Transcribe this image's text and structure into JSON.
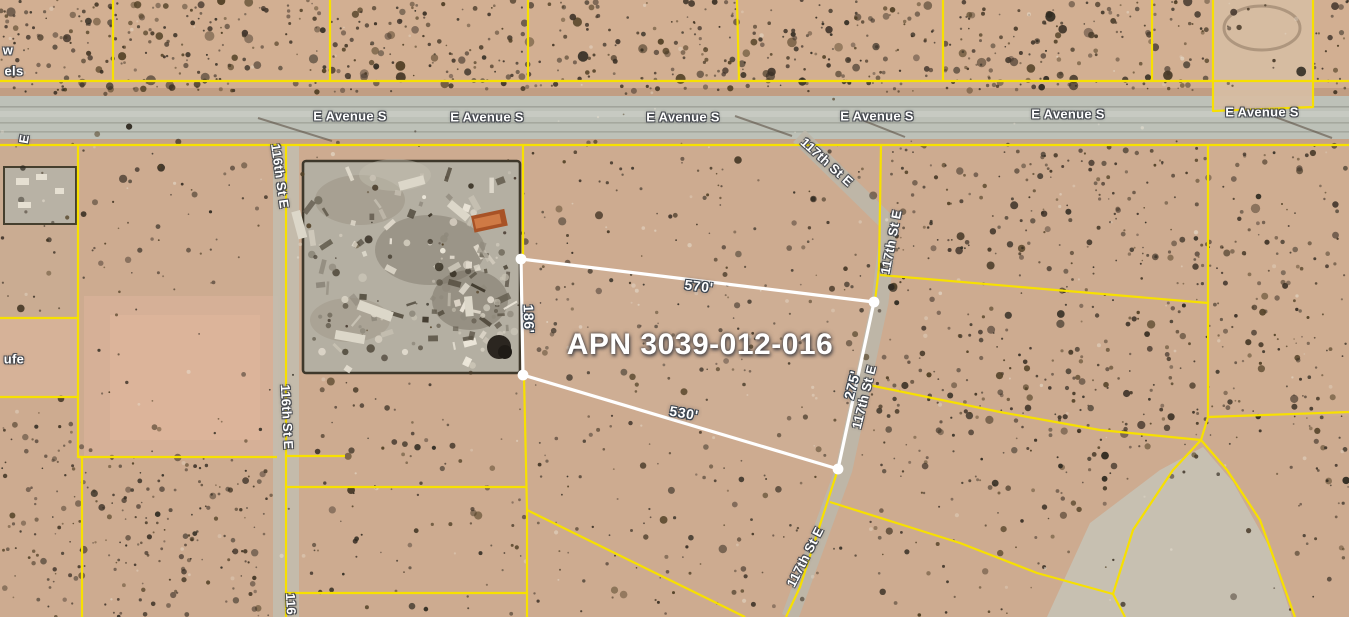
{
  "map": {
    "apn_label": {
      "text": "APN 3039-012-016",
      "x": 700,
      "y": 345
    },
    "parcel": {
      "corners": [
        [
          521,
          259
        ],
        [
          874,
          302
        ],
        [
          838,
          469
        ],
        [
          523,
          375
        ]
      ],
      "dimension_labels": [
        {
          "text": "570'",
          "x": 699,
          "y": 286,
          "r": 7
        },
        {
          "text": "186'",
          "x": 529,
          "y": 319,
          "r": 88
        },
        {
          "text": "275'",
          "x": 852,
          "y": 385,
          "r": -76
        },
        {
          "text": "530'",
          "x": 684,
          "y": 413,
          "r": 10
        }
      ]
    },
    "street_labels": [
      {
        "text": "E Avenue S",
        "x": 350,
        "y": 116,
        "r": 0
      },
      {
        "text": "E Avenue S",
        "x": 487,
        "y": 117,
        "r": 0
      },
      {
        "text": "E Avenue S",
        "x": 683,
        "y": 117,
        "r": 0
      },
      {
        "text": "E Avenue S",
        "x": 877,
        "y": 116,
        "r": 0
      },
      {
        "text": "E Avenue S",
        "x": 1068,
        "y": 114,
        "r": 0
      },
      {
        "text": "E Avenue S",
        "x": 1262,
        "y": 112,
        "r": 0
      },
      {
        "text": "116th St E",
        "x": 280,
        "y": 176,
        "r": 82
      },
      {
        "text": "116th St E",
        "x": 287,
        "y": 417,
        "r": 87
      },
      {
        "text": "116",
        "x": 291,
        "y": 604,
        "r": 87
      },
      {
        "text": "117th St E",
        "x": 827,
        "y": 162,
        "r": 42
      },
      {
        "text": "117th St E",
        "x": 891,
        "y": 242,
        "r": -79
      },
      {
        "text": "117th St E",
        "x": 864,
        "y": 397,
        "r": -76
      },
      {
        "text": "117th St E",
        "x": 805,
        "y": 557,
        "r": -63
      },
      {
        "text": "E",
        "x": 24,
        "y": 139,
        "r": -80
      }
    ],
    "edge_partial_labels": [
      {
        "text": "w",
        "x": 8,
        "y": 50
      },
      {
        "text": "els",
        "x": 14,
        "y": 71
      },
      {
        "text": "ufe",
        "x": 14,
        "y": 359
      }
    ],
    "parcel_lines": [
      [
        [
          0,
          81
        ],
        [
          1349,
          81
        ]
      ],
      [
        [
          113,
          0
        ],
        [
          113,
          81
        ]
      ],
      [
        [
          330,
          0
        ],
        [
          330,
          81
        ]
      ],
      [
        [
          528,
          0
        ],
        [
          528,
          81
        ]
      ],
      [
        [
          737,
          0
        ],
        [
          739,
          81
        ]
      ],
      [
        [
          943,
          0
        ],
        [
          943,
          81
        ]
      ],
      [
        [
          1152,
          0
        ],
        [
          1152,
          81
        ]
      ],
      [
        [
          1213,
          0
        ],
        [
          1213,
          111
        ],
        [
          1313,
          107
        ],
        [
          1313,
          0
        ]
      ],
      [
        [
          0,
          145
        ],
        [
          1349,
          145
        ]
      ],
      [
        [
          78,
          145
        ],
        [
          78,
          457
        ],
        [
          82,
          457
        ],
        [
          82,
          617
        ]
      ],
      [
        [
          0,
          318
        ],
        [
          78,
          318
        ]
      ],
      [
        [
          0,
          397
        ],
        [
          78,
          397
        ]
      ],
      [
        [
          78,
          457
        ],
        [
          277,
          457
        ]
      ],
      [
        [
          286,
          145
        ],
        [
          286,
          617
        ]
      ],
      [
        [
          286,
          456
        ],
        [
          345,
          456
        ]
      ],
      [
        [
          286,
          487
        ],
        [
          527,
          487
        ]
      ],
      [
        [
          286,
          593
        ],
        [
          527,
          593
        ]
      ],
      [
        [
          523,
          145
        ],
        [
          523,
          257
        ]
      ],
      [
        [
          524,
          377
        ],
        [
          527,
          510
        ],
        [
          527,
          617
        ]
      ],
      [
        [
          527,
          510
        ],
        [
          745,
          617
        ]
      ],
      [
        [
          881,
          145
        ],
        [
          879,
          268
        ],
        [
          875,
          301
        ]
      ],
      [
        [
          880,
          275
        ],
        [
          1208,
          303
        ]
      ],
      [
        [
          1208,
          145
        ],
        [
          1208,
          417
        ],
        [
          1201,
          440
        ]
      ],
      [
        [
          1208,
          417
        ],
        [
          1349,
          412
        ]
      ],
      [
        [
          1201,
          440
        ],
        [
          1173,
          470
        ],
        [
          1133,
          530
        ],
        [
          1113,
          594
        ]
      ],
      [
        [
          1201,
          440
        ],
        [
          1227,
          470
        ],
        [
          1260,
          520
        ],
        [
          1295,
          617
        ]
      ],
      [
        [
          1113,
          594
        ],
        [
          1125,
          617
        ]
      ],
      [
        [
          830,
          502
        ],
        [
          960,
          543
        ],
        [
          1037,
          573
        ],
        [
          1113,
          594
        ]
      ],
      [
        [
          838,
          469
        ],
        [
          800,
          587
        ],
        [
          786,
          617
        ]
      ],
      [
        [
          864,
          384
        ],
        [
          1000,
          412
        ],
        [
          1100,
          430
        ],
        [
          1201,
          440
        ]
      ]
    ],
    "colors": {
      "parcel_line": "#f7e001",
      "parcel_highlight": "#ffffff",
      "road": "#bdc1b8",
      "terrain": "#cdab90",
      "label_halo": "#444850"
    }
  }
}
